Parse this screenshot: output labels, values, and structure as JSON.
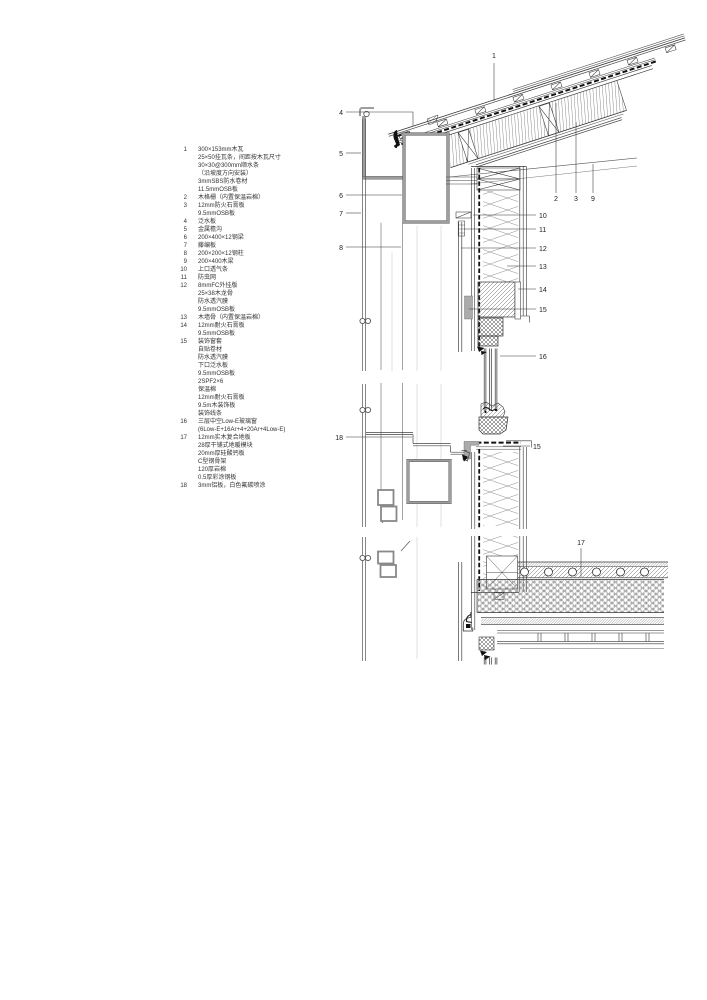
{
  "legend": {
    "items": [
      {
        "num": "1",
        "text": "300×153mm木瓦\n25×50挂瓦条，间距按木瓦尺寸\n30×30@300mm顺水条\n（沿坡度方向安装）\n3mmSBS防水卷材\n11.5mmOSB板"
      },
      {
        "num": "2",
        "text": "木格栅（内置保温岩棉）"
      },
      {
        "num": "3",
        "text": "12mm防火石膏板\n9.5mmOSB板"
      },
      {
        "num": "4",
        "text": "泛水板"
      },
      {
        "num": "5",
        "text": "金属檐沟"
      },
      {
        "num": "6",
        "text": "200×400×12钢梁"
      },
      {
        "num": "7",
        "text": "藤编板"
      },
      {
        "num": "8",
        "text": "200×200×12钢柱"
      },
      {
        "num": "9",
        "text": "200×400木梁"
      },
      {
        "num": "10",
        "text": "上口透气条"
      },
      {
        "num": "11",
        "text": "防虫网"
      },
      {
        "num": "12",
        "text": "8mmFC外挂版\n25×38木龙骨\n防水透汽膜\n9.5mmOSB板"
      },
      {
        "num": "13",
        "text": "木墙骨（内置保温岩棉）"
      },
      {
        "num": "14",
        "text": "12mm耐火石膏板\n9.5mmOSB板"
      },
      {
        "num": "15",
        "text": "装饰窗套\n自贴卷材\n防水透汽膜\n下口泛水板\n9.5mmOSB板\n2SPF2×6\n保温棉\n12mm耐火石膏板\n9.5m木装饰板\n装饰线条"
      },
      {
        "num": "16",
        "text": "三层中空Low-E玻璃窗\n(6Low-E+16Ar+4+20Ar+4Low-E)"
      },
      {
        "num": "17",
        "text": "12mm实木复合地板\n28厚干铺式地暖模块\n20mm厚硅酸钙板\nC型钢骨架\n120厚岩棉\n0.5厚彩涂钢板"
      },
      {
        "num": "18",
        "text": "3mm铝板，白色氟碳喷涂"
      }
    ]
  },
  "callouts": {
    "c1": "1",
    "c2": "2",
    "c3": "3",
    "c4": "4",
    "c5": "5",
    "c6": "6",
    "c7": "7",
    "c8": "8",
    "c9": "9",
    "c10": "10",
    "c11": "11",
    "c12": "12",
    "c13": "13",
    "c14": "14",
    "c15": "15",
    "c16": "16",
    "c17": "17",
    "c18": "18"
  },
  "colors": {
    "line": "#222222",
    "steel": "#9e9e9e",
    "membrane": "#111111",
    "background": "#ffffff"
  }
}
